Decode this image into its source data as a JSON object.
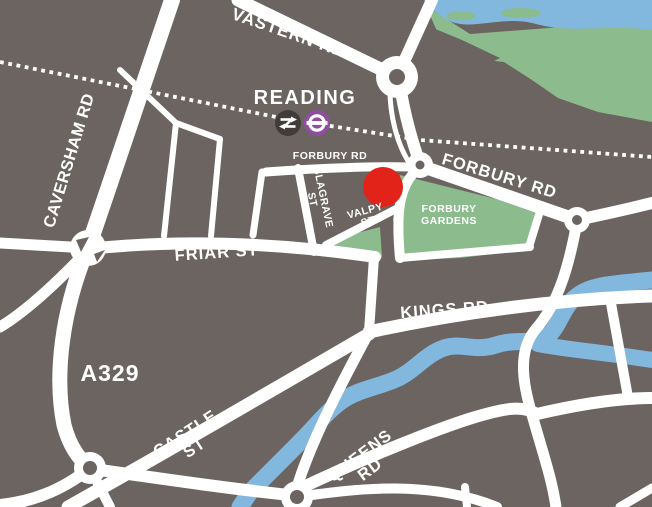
{
  "map": {
    "type": "stylised-street-map",
    "station": {
      "name": "READING",
      "icons": [
        {
          "name": "national-rail-icon"
        },
        {
          "name": "elizabeth-line-roundel-icon"
        }
      ]
    },
    "marker": {
      "name": "location-marker",
      "color": "#e2231a"
    },
    "colors": {
      "background": "#6b6460",
      "road": "#ffffff",
      "water": "#82b7de",
      "park": "#8cbc8e",
      "marker": "#e2231a",
      "roundel_purple": "#8e4f9f",
      "rail_badge_dark": "#413c39",
      "label_text": "#ffffff"
    },
    "labels": [
      {
        "id": "vastern-rd",
        "lines": [
          "VASTERN RD"
        ],
        "x": 287,
        "y": 38,
        "rotate": 19,
        "size": 17,
        "spacing": 1
      },
      {
        "id": "caversham-rd",
        "lines": [
          "CAVERSHAM RD"
        ],
        "x": 74,
        "y": 162,
        "rotate": -73,
        "size": 16.5,
        "spacing": 0.5
      },
      {
        "id": "reading-station",
        "lines": [
          "READING"
        ],
        "x": 305,
        "y": 104,
        "rotate": 0,
        "size": 20,
        "spacing": 1.5
      },
      {
        "id": "forbury-rd-west",
        "lines": [
          "FORBURY RD"
        ],
        "x": 330,
        "y": 159,
        "rotate": 0,
        "size": 10.5,
        "spacing": 0.5
      },
      {
        "id": "blagrave-st",
        "lines": [
          "BLAGRAVE",
          "ST"
        ],
        "x": 320,
        "y": 198,
        "rotate": 78,
        "size": 10.5,
        "spacing": 0.5,
        "lineHeight": 11
      },
      {
        "id": "valpy-st",
        "lines": [
          "VALPY",
          "ST"
        ],
        "x": 366,
        "y": 214,
        "rotate": -15,
        "size": 10.5,
        "spacing": 0.5,
        "lineHeight": 11
      },
      {
        "id": "forbury-rd-east",
        "lines": [
          "FORBURY RD"
        ],
        "x": 498,
        "y": 181,
        "rotate": 17,
        "size": 16.5,
        "spacing": 1
      },
      {
        "id": "forbury-gardens",
        "lines": [
          "FORBURY",
          "GARDENS"
        ],
        "x": 449,
        "y": 212,
        "rotate": 0,
        "size": 10.5,
        "spacing": 0.5,
        "lineHeight": 12
      },
      {
        "id": "friar-st",
        "lines": [
          "FRIAR ST"
        ],
        "x": 217,
        "y": 258,
        "rotate": -4,
        "size": 16.5,
        "spacing": 1
      },
      {
        "id": "kings-rd",
        "lines": [
          "KINGS RD"
        ],
        "x": 445,
        "y": 315,
        "rotate": -4,
        "size": 16.5,
        "spacing": 1
      },
      {
        "id": "a329",
        "lines": [
          "A329"
        ],
        "x": 110,
        "y": 381,
        "rotate": 0,
        "size": 23,
        "spacing": 1
      },
      {
        "id": "castle-st",
        "lines": [
          "CASTLE",
          "ST"
        ],
        "x": 188,
        "y": 438,
        "rotate": -33,
        "size": 16.5,
        "spacing": 1,
        "lineHeight": 17
      },
      {
        "id": "queens-rd",
        "lines": [
          "QUEENS",
          "RD"
        ],
        "x": 363,
        "y": 460,
        "rotate": -37,
        "size": 16.5,
        "spacing": 1,
        "lineHeight": 17
      }
    ]
  }
}
